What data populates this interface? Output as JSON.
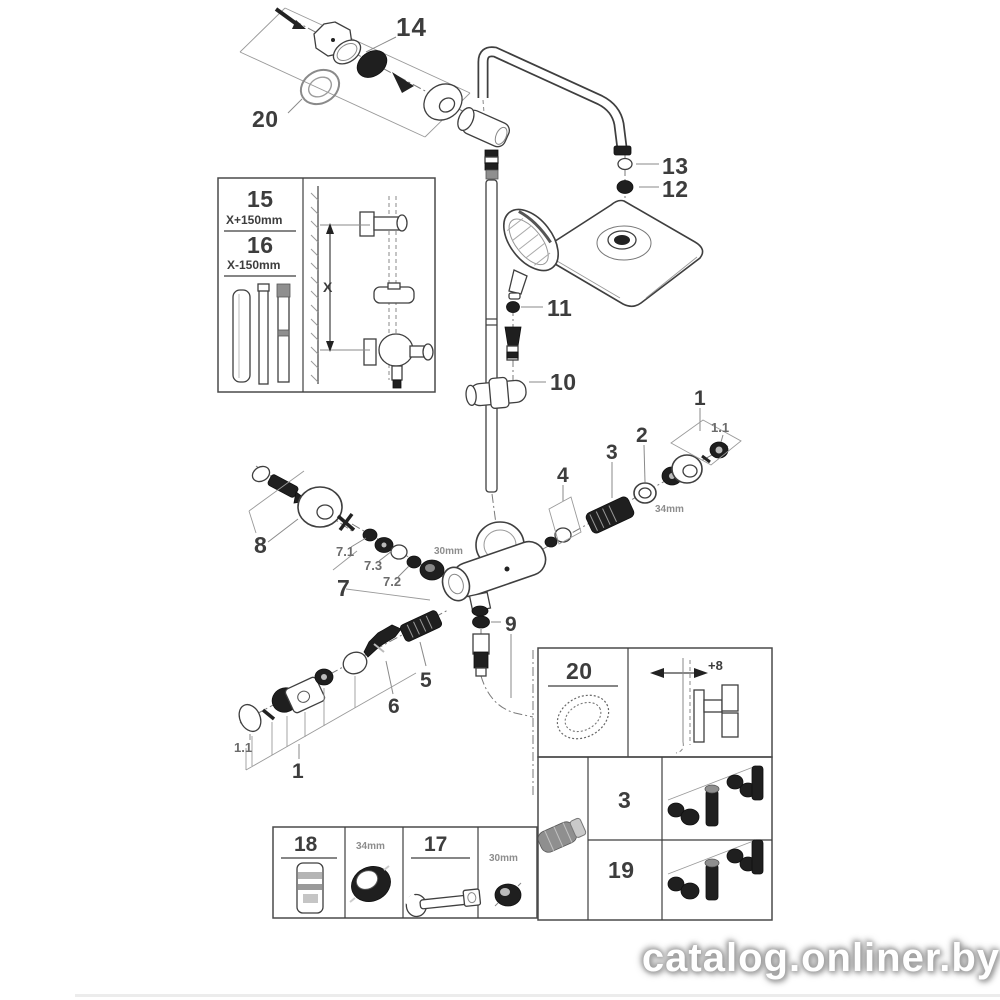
{
  "watermark": {
    "text": "catalog.onliner.by"
  },
  "callouts": {
    "c14": "14",
    "c20": "20",
    "c13": "13",
    "c12": "12",
    "c11": "11",
    "c10": "10",
    "c9": "9",
    "c8": "8",
    "c7": "7",
    "c71": "7.1",
    "c72": "7.2",
    "c73": "7.3",
    "c6": "6",
    "c5": "5",
    "c4": "4",
    "c3": "3",
    "c2": "2",
    "c1_right": "1",
    "c11_right": "1.1",
    "c1_bottom": "1",
    "c11_bottom": "1.1",
    "dim34": "34mm",
    "dim30": "30mm"
  },
  "inset_heights": {
    "part15": "15",
    "part15_dim": "X+150mm",
    "part16": "16",
    "part16_dim": "X-150mm",
    "x_label": "X"
  },
  "inset_seal": {
    "part20": "20",
    "offset": "+8"
  },
  "inset_service": {
    "part3": "3",
    "part19": "19"
  },
  "inset_tools": {
    "part18": "18",
    "dim34": "34mm",
    "part17": "17",
    "dim30": "30mm"
  }
}
